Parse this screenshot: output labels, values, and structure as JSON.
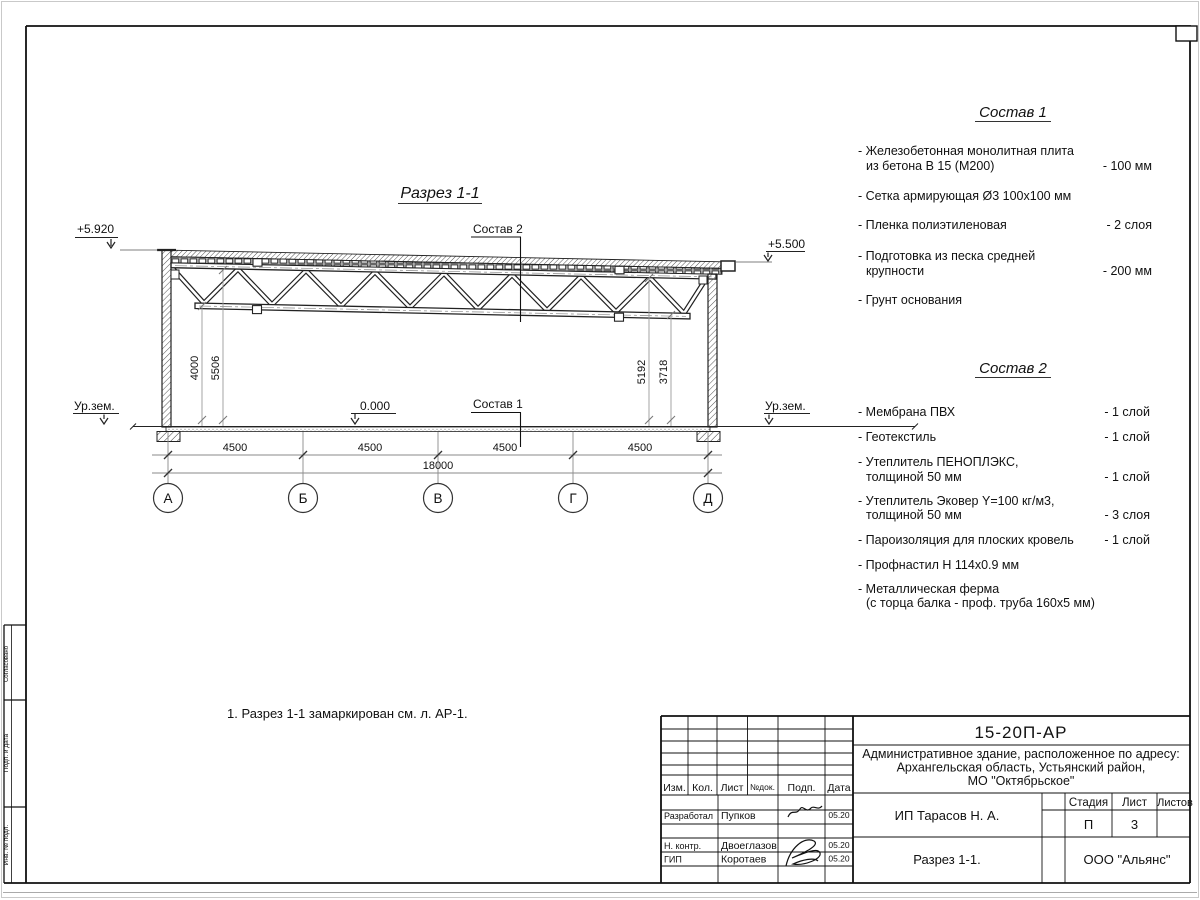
{
  "sheet": {
    "drawing_title": "Разрез 1-1",
    "note": "1. Разрез 1-1 замаркирован см. л. АР-1.",
    "side_labels": {
      "top": "Согласовано",
      "mid": "Подп. и дата",
      "bottom": "Инв. № подл."
    }
  },
  "section": {
    "elevations": {
      "left_top": "+5.920",
      "right_top": "+5.500",
      "zero": "0.000",
      "ground_left": "Ур.зем.",
      "ground_right": "Ур.зем."
    },
    "callouts": {
      "roof": "Состав 2",
      "floor": "Состав 1"
    },
    "heights_left": [
      "4000",
      "5506"
    ],
    "heights_right": [
      "5192",
      "3718"
    ],
    "dims_bottom": [
      "4500",
      "4500",
      "4500",
      "4500"
    ],
    "dim_total": "18000",
    "axes": [
      "А",
      "Б",
      "В",
      "Г",
      "Д"
    ]
  },
  "comp1": {
    "title": "Состав 1",
    "items": [
      {
        "l1": "- Железобетонная  монолитная плита",
        "l2": "из бетона В 15 (М200)",
        "val": "- 100 мм"
      },
      {
        "l1": "- Сетка армирующая Ø3 100х100 мм"
      },
      {
        "l1": "- Пленка полиэтиленовая",
        "val": "-  2 слоя"
      },
      {
        "l1": "- Подготовка из песка средней",
        "l2": "крупности",
        "val": "- 200 мм"
      },
      {
        "l1": "- Грунт основания"
      }
    ]
  },
  "comp2": {
    "title": "Состав 2",
    "items": [
      {
        "l1": "- Мембрана ПВХ",
        "val": "- 1 слой"
      },
      {
        "l1": "- Геотекстиль",
        "val": "- 1 слой"
      },
      {
        "l1": "- Утеплитель ПЕНОПЛЭКС,",
        "l2": "толщиной 50 мм",
        "val": "- 1 слой"
      },
      {
        "l1": "- Утеплитель Эковер Y=100 кг/м3,",
        "l2": "толщиной 50 мм",
        "val": "- 3 слоя"
      },
      {
        "l1": "- Пароизоляция для плоских кровель",
        "val": "- 1 слой"
      },
      {
        "l1": "- Профнастил Н 114х0.9 мм"
      },
      {
        "l1": "- Металлическая ферма",
        "l2": "(с торца балка - проф. труба 160х5 мм)"
      }
    ]
  },
  "title_block": {
    "doc_number": "15-20П-АР",
    "address_line1": "Административное здание, расположенное по адресу:",
    "address_line2": "Архангельская область, Устьянский район,",
    "address_line3": "МО \"Октябрьское\"",
    "col_izm": "Изм.",
    "col_kol": "Кол.",
    "col_list": "Лист",
    "col_ndok": "№док.",
    "col_podp": "Подп.",
    "col_data": "Дата",
    "rows": [
      {
        "role": "Разработал",
        "name": "Пупков",
        "date": "05.20"
      },
      {
        "role": "Н. контр.",
        "name": "Двоеглазов",
        "date": "05.20"
      },
      {
        "role": "ГИП",
        "name": "Коротаев",
        "date": "05.20"
      }
    ],
    "client": "ИП Тарасов Н. А.",
    "sheet_title": "Разрез 1-1.",
    "company": "ООО \"Альянс\"",
    "stage_label": "Стадия",
    "sheet_label": "Лист",
    "sheets_label": "Листов",
    "stage": "П",
    "sheet_no": "3"
  },
  "colors": {
    "line": "#1a1a1a",
    "dim": "#999999",
    "frame": "#111111"
  }
}
